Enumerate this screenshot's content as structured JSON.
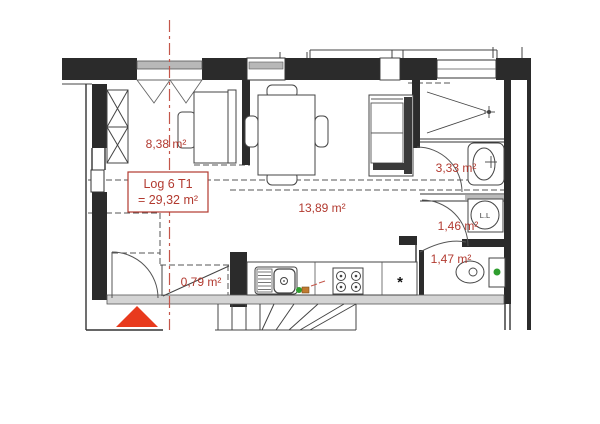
{
  "plan": {
    "unit_label": {
      "line1": "Log 6 T1",
      "line2": "= 29,32 m²"
    },
    "rooms": [
      {
        "id": "bedroom",
        "area_label": "8,38 m²"
      },
      {
        "id": "living",
        "area_label": "13,89 m²"
      },
      {
        "id": "bathroom",
        "area_label": "3,33 m²"
      },
      {
        "id": "laundry",
        "area_label": "1,46 m²"
      },
      {
        "id": "wc",
        "area_label": "1,47 m²"
      },
      {
        "id": "entry-closet",
        "area_label": "0,79 m²"
      }
    ],
    "appliances": {
      "washing_machine_label": "L.L",
      "fridge_symbol": "*"
    },
    "colors": {
      "annotation_red": "#b23a30",
      "axis_red": "#c4564a",
      "arrow_red": "#e83a1d",
      "green_dot": "#2f9e2f",
      "wall_black": "#2b2b2b"
    }
  }
}
